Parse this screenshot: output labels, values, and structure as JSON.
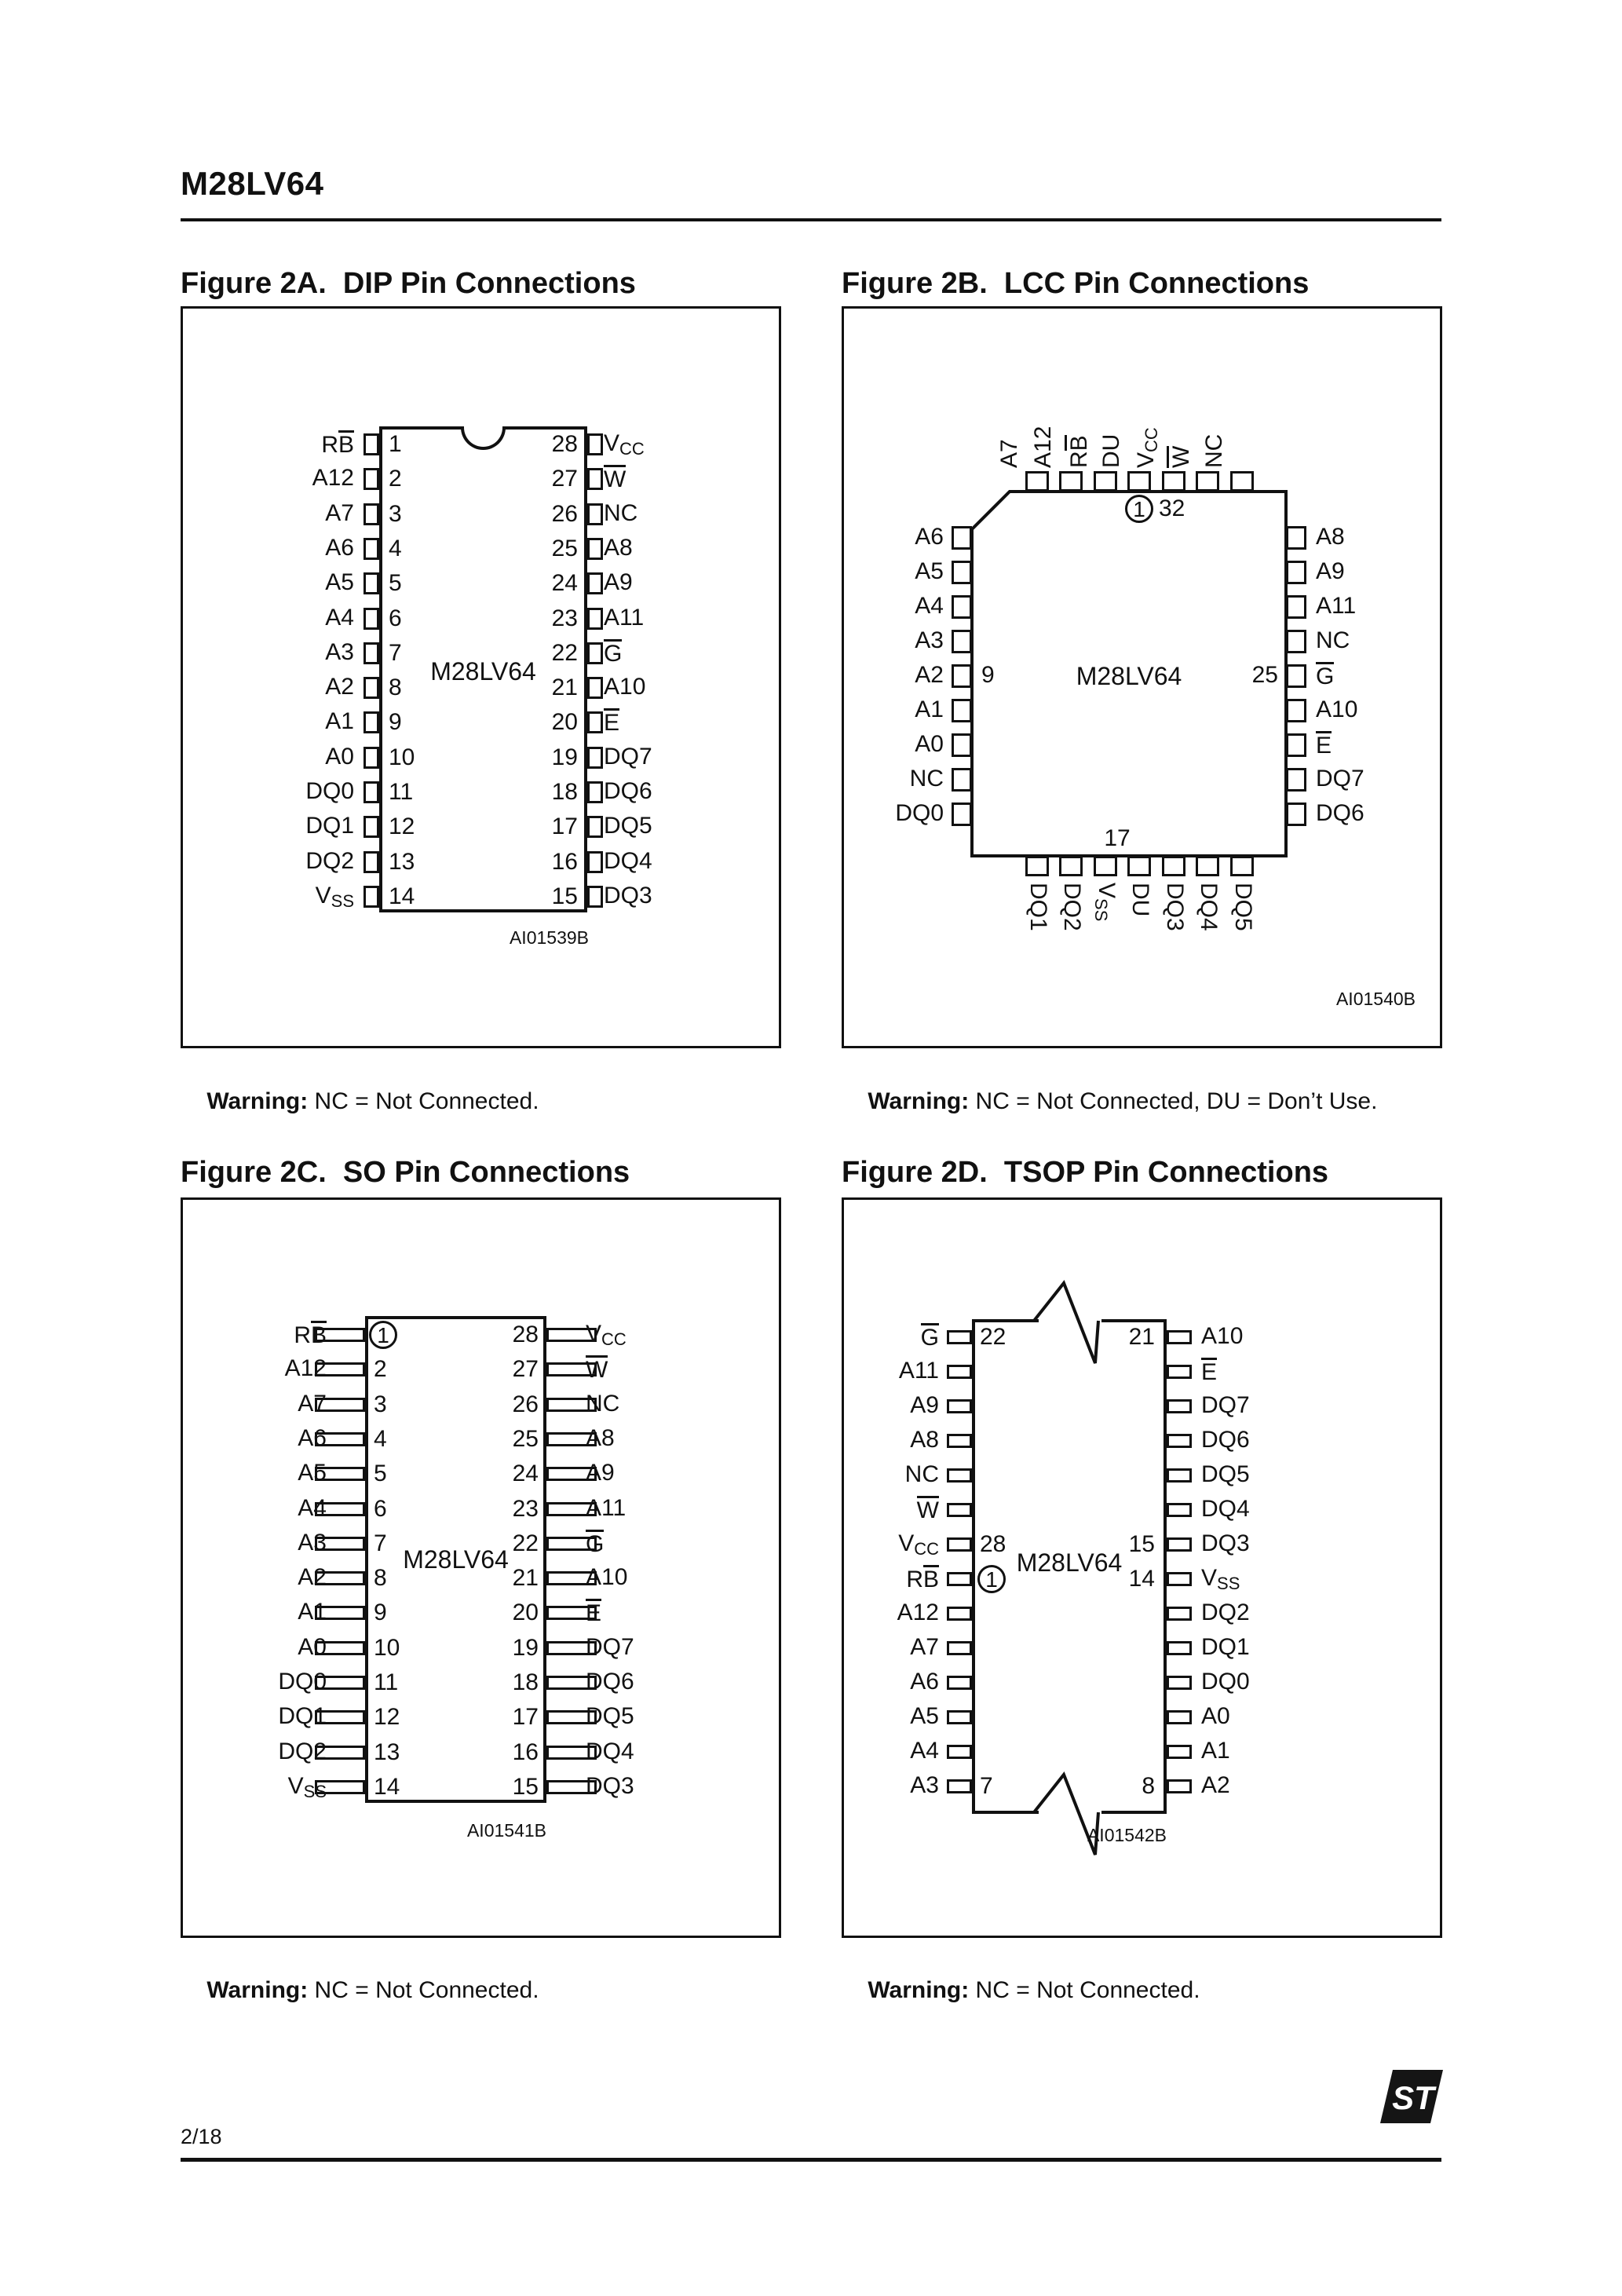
{
  "header": {
    "part_number": "M28LV64"
  },
  "footer": {
    "page": "2/18",
    "logo_text": "ST"
  },
  "figures": [
    {
      "id": "2A",
      "package": "DIP",
      "title": "Figure 2A.  DIP Pin Connections",
      "chip_label": "M28LV64",
      "ref": "AI01539B",
      "warning_label": "Warning:",
      "warning_text": " NC = Not Connected.",
      "left_pins": [
        {
          "num": "1",
          "label": "R[B]"
        },
        {
          "num": "2",
          "label": "A12"
        },
        {
          "num": "3",
          "label": "A7"
        },
        {
          "num": "4",
          "label": "A6"
        },
        {
          "num": "5",
          "label": "A5"
        },
        {
          "num": "6",
          "label": "A4"
        },
        {
          "num": "7",
          "label": "A3"
        },
        {
          "num": "8",
          "label": "A2"
        },
        {
          "num": "9",
          "label": "A1"
        },
        {
          "num": "10",
          "label": "A0"
        },
        {
          "num": "11",
          "label": "DQ0"
        },
        {
          "num": "12",
          "label": "DQ1"
        },
        {
          "num": "13",
          "label": "DQ2"
        },
        {
          "num": "14",
          "label": "V{SS}"
        }
      ],
      "right_pins": [
        {
          "num": "28",
          "label": "V{CC}"
        },
        {
          "num": "27",
          "label": "[W]"
        },
        {
          "num": "26",
          "label": "NC"
        },
        {
          "num": "25",
          "label": "A8"
        },
        {
          "num": "24",
          "label": "A9"
        },
        {
          "num": "23",
          "label": "A11"
        },
        {
          "num": "22",
          "label": "[G]"
        },
        {
          "num": "21",
          "label": "A10"
        },
        {
          "num": "20",
          "label": "[E]"
        },
        {
          "num": "19",
          "label": "DQ7"
        },
        {
          "num": "18",
          "label": "DQ6"
        },
        {
          "num": "17",
          "label": "DQ5"
        },
        {
          "num": "16",
          "label": "DQ4"
        },
        {
          "num": "15",
          "label": "DQ3"
        }
      ]
    },
    {
      "id": "2B",
      "package": "LCC",
      "title": "Figure 2B.  LCC Pin Connections",
      "chip_label": "M28LV64",
      "ref": "AI01540B",
      "warning_label": "Warning:",
      "warning_text": " NC = Not Connected, DU = Don’t Use.",
      "top_pins": [
        "A7",
        "A12",
        "R[B]",
        "DU",
        "V{CC}",
        "[W]",
        "NC"
      ],
      "left_pins": [
        "A6",
        "A5",
        "A4",
        "A3",
        "A2",
        "A1",
        "A0",
        "NC",
        "DQ0"
      ],
      "right_pins": [
        "A8",
        "A9",
        "A11",
        "NC",
        "[G]",
        "A10",
        "[E]",
        "DQ7",
        "DQ6"
      ],
      "bottom_pins": [
        "DQ1",
        "DQ2",
        "V{SS}",
        "DU",
        "DQ3",
        "DQ4",
        "DQ5"
      ],
      "pin1_text": "1",
      "pin1_count": "32",
      "left_side_num": {
        "row": 4,
        "text": "9"
      },
      "right_side_num": {
        "row": 4,
        "text": "25"
      },
      "bottom_num": "17"
    },
    {
      "id": "2C",
      "package": "SO",
      "title": "Figure 2C.  SO Pin Connections",
      "chip_label": "M28LV64",
      "ref": "AI01541B",
      "warning_label": "Warning:",
      "warning_text": " NC = Not Connected.",
      "pin1_circled": true,
      "left_pins": [
        {
          "num": "1",
          "label": "R[B]",
          "circled": true
        },
        {
          "num": "2",
          "label": "A12"
        },
        {
          "num": "3",
          "label": "A7"
        },
        {
          "num": "4",
          "label": "A6"
        },
        {
          "num": "5",
          "label": "A5"
        },
        {
          "num": "6",
          "label": "A4"
        },
        {
          "num": "7",
          "label": "A3"
        },
        {
          "num": "8",
          "label": "A2"
        },
        {
          "num": "9",
          "label": "A1"
        },
        {
          "num": "10",
          "label": "A0"
        },
        {
          "num": "11",
          "label": "DQ0"
        },
        {
          "num": "12",
          "label": "DQ1"
        },
        {
          "num": "13",
          "label": "DQ2"
        },
        {
          "num": "14",
          "label": "V{SS}"
        }
      ],
      "right_pins": [
        {
          "num": "28",
          "label": "V{CC}"
        },
        {
          "num": "27",
          "label": "[W]"
        },
        {
          "num": "26",
          "label": "NC"
        },
        {
          "num": "25",
          "label": "A8"
        },
        {
          "num": "24",
          "label": "A9"
        },
        {
          "num": "23",
          "label": "A11"
        },
        {
          "num": "22",
          "label": "[G]"
        },
        {
          "num": "21",
          "label": "A10"
        },
        {
          "num": "20",
          "label": "[E]"
        },
        {
          "num": "19",
          "label": "DQ7"
        },
        {
          "num": "18",
          "label": "DQ6"
        },
        {
          "num": "17",
          "label": "DQ5"
        },
        {
          "num": "16",
          "label": "DQ4"
        },
        {
          "num": "15",
          "label": "DQ3"
        }
      ]
    },
    {
      "id": "2D",
      "package": "TSOP",
      "title": "Figure 2D.  TSOP Pin Connections",
      "chip_label": "M28LV64",
      "ref": "AI01542B",
      "warning_label": "Warning:",
      "warning_text": " NC = Not Connected.",
      "left_pins": [
        {
          "label": "[G]",
          "num": "22"
        },
        {
          "label": "A11"
        },
        {
          "label": "A9"
        },
        {
          "label": "A8"
        },
        {
          "label": "NC"
        },
        {
          "label": "[W]"
        },
        {
          "label": "V{CC}",
          "num": "28"
        },
        {
          "label": "R[B]",
          "circled": true,
          "circle_text": "1"
        },
        {
          "label": "A12"
        },
        {
          "label": "A7"
        },
        {
          "label": "A6"
        },
        {
          "label": "A5"
        },
        {
          "label": "A4"
        },
        {
          "label": "A3",
          "num": "7"
        }
      ],
      "right_pins": [
        {
          "label": "A10",
          "num": "21"
        },
        {
          "label": "[E]"
        },
        {
          "label": "DQ7"
        },
        {
          "label": "DQ6"
        },
        {
          "label": "DQ5"
        },
        {
          "label": "DQ4"
        },
        {
          "label": "DQ3",
          "num": "15"
        },
        {
          "label": "V{SS}",
          "num": "14"
        },
        {
          "label": "DQ2"
        },
        {
          "label": "DQ1"
        },
        {
          "label": "DQ0"
        },
        {
          "label": "A0"
        },
        {
          "label": "A1"
        },
        {
          "label": "A2",
          "num": "8"
        }
      ]
    }
  ]
}
